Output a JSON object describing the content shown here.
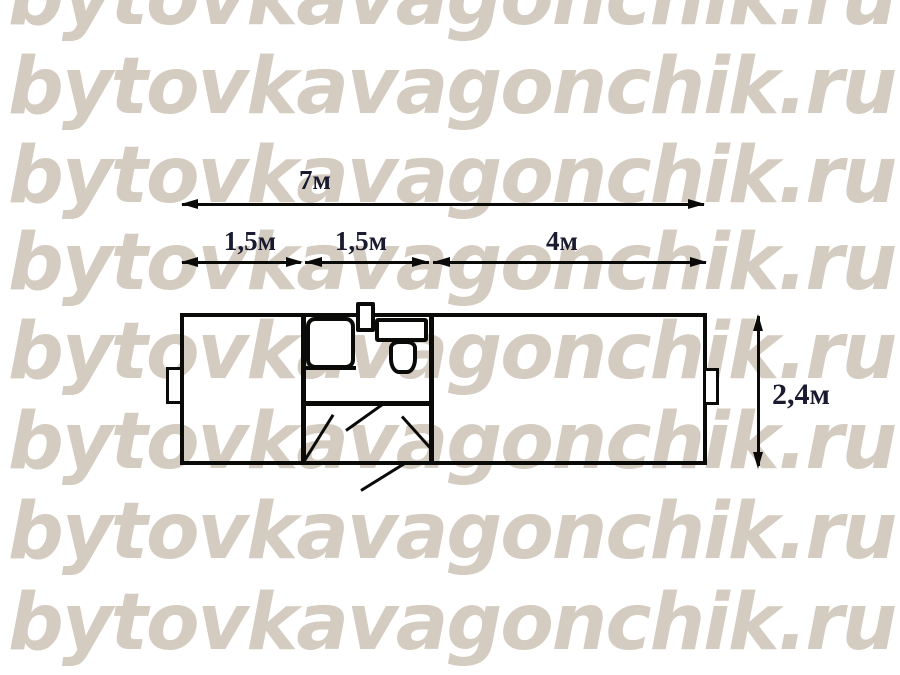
{
  "watermark": {
    "text": "bytovkavagonchik.ru",
    "rows": 8,
    "color": "#d4ccc0"
  },
  "dimensions": {
    "text_color": "#1a1a30",
    "total_length": {
      "label": "7м",
      "value": 7
    },
    "sections": [
      {
        "label": "1,5м",
        "value": 1.5
      },
      {
        "label": "1,5м",
        "value": 1.5
      },
      {
        "label": "4м",
        "value": 4
      }
    ],
    "height": {
      "label": "2,4м",
      "value": 2.4
    }
  },
  "plan": {
    "line_color": "#0a0a08",
    "fixtures": [
      "left-window",
      "right-window",
      "washbasin",
      "water-heater",
      "toilet-cistern",
      "toilet-bowl",
      "room-door-left",
      "wc-door",
      "room-door-right",
      "entrance-door"
    ]
  }
}
